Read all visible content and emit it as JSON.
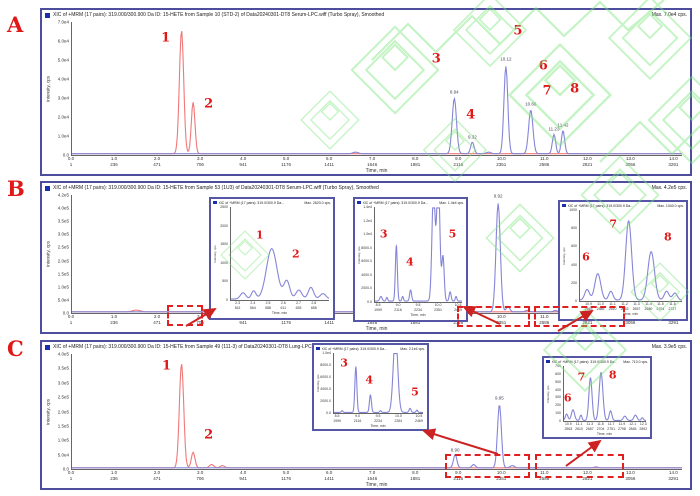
{
  "figure": {
    "panel_labels": [
      "A",
      "B",
      "C"
    ],
    "accent_red": "#e01818",
    "watermark_green": "#7be57b",
    "trace_red": "#f07878",
    "trace_blue": "#8585d8"
  },
  "chart_data": [
    {
      "id": "panel-A-main",
      "type": "line",
      "title": "XIC of +MRM (17 pairs): 319.000/300.900 Da ID: 15-HETE from Sample 10 (STD-2) of Data20240301-DT8 Serum-LPC.wiff (Turbo Spray), Smoothed",
      "max_label": "Max. 7.0e4 cps.",
      "ylabel": "Intensity, cps",
      "xlabel": "Time, min",
      "xmin": 0,
      "xmax": 14.2,
      "yticks": [
        "7.0e4",
        "6.0e4",
        "5.0e4",
        "4.0e4",
        "3.0e4",
        "2.0e4",
        "1.0e4",
        "0.0"
      ],
      "xticks": [
        "0.0",
        "1.0",
        "2.0",
        "3.0",
        "4.0",
        "5.0",
        "6.0",
        "7.0",
        "8.0",
        "9.0",
        "10.0",
        "11.0",
        "12.0",
        "13.0",
        "14.0"
      ],
      "scanticks": [
        "1",
        "236",
        "471",
        "706",
        "941",
        "1176",
        "1411",
        "1646",
        "1881",
        "2116",
        "2351",
        "2586",
        "2821",
        "3056",
        "3291"
      ],
      "traces": [
        {
          "name": "red-trace",
          "color": "#f07878",
          "peaks": [
            {
              "rt": 2.55,
              "h": 0.96,
              "w": 0.05,
              "label": "1",
              "lx": 2.18,
              "ly": 0.12
            },
            {
              "rt": 2.82,
              "h": 0.4,
              "w": 0.042,
              "label": "2",
              "lx": 3.18,
              "ly": 0.62
            }
          ]
        },
        {
          "name": "blue-trace",
          "color": "#8585d8",
          "peaks": [
            {
              "rt": 8.9,
              "h": 0.43,
              "w": 0.05,
              "rt_label": "8.94",
              "label": "3",
              "lx": 8.48,
              "ly": 0.28
            },
            {
              "rt": 9.32,
              "h": 0.09,
              "w": 0.04,
              "rt_label": "9.32",
              "label": "4",
              "lx": 9.28,
              "ly": 0.7
            },
            {
              "rt": 10.1,
              "h": 0.68,
              "w": 0.045,
              "rt_label": "10.12",
              "label": "5",
              "lx": 10.38,
              "ly": 0.07
            },
            {
              "rt": 10.68,
              "h": 0.34,
              "w": 0.05,
              "rt_label": "10.66",
              "label": "6",
              "lx": 10.97,
              "ly": 0.33
            },
            {
              "rt": 11.22,
              "h": 0.15,
              "w": 0.038,
              "rt_label": "11.23",
              "label": "7",
              "lx": 11.06,
              "ly": 0.52
            },
            {
              "rt": 11.43,
              "h": 0.18,
              "w": 0.038,
              "rt_label": "11.42",
              "label": "8",
              "lx": 11.7,
              "ly": 0.5
            },
            {
              "rt": 6.6,
              "h": 0.012,
              "w": 0.06
            },
            {
              "rt": 9.7,
              "h": 0.012,
              "w": 0.05
            }
          ]
        }
      ]
    },
    {
      "id": "panel-B-main",
      "type": "line",
      "title": "XIC of +MRM (17 pairs): 319.000/300.900 Da ID: 15-HETE from Sample 53 (1U3) of Data20240301-DT8 Serum-LPC.wiff (Turbo Spray), Smoothed",
      "max_label": "Max. 4.2e5 cps.",
      "ylabel": "Intensity, cps",
      "xlabel": "Time, min",
      "xmin": 0,
      "xmax": 14.2,
      "yticks": [
        "4.2e5",
        "4.0e5",
        "3.5e5",
        "3.0e5",
        "2.5e5",
        "2.0e5",
        "1.5e5",
        "1.0e5",
        "5.0e4",
        "0.0"
      ],
      "xticks": [
        "0.0",
        "1.0",
        "2.0",
        "3.0",
        "4.0",
        "5.0",
        "6.0",
        "7.0",
        "8.0",
        "9.0",
        "10.0",
        "11.0",
        "12.0",
        "13.0",
        "14.0"
      ],
      "scanticks": [
        "1",
        "236",
        "471",
        "706",
        "941",
        "1176",
        "1411",
        "1646",
        "1881",
        "2116",
        "2351",
        "2586",
        "2821",
        "3056",
        "3291"
      ],
      "traces": [
        {
          "name": "red-trace",
          "color": "#f07878",
          "peaks": [
            {
              "rt": 1.5,
              "h": 0.015,
              "w": 0.09
            }
          ]
        },
        {
          "name": "blue-trace",
          "color": "#8585d8",
          "peaks": [
            {
              "rt": 8.94,
              "h": 0.035,
              "w": 0.04
            },
            {
              "rt": 9.3,
              "h": 0.02,
              "w": 0.04
            },
            {
              "rt": 9.92,
              "h": 0.95,
              "w": 0.05,
              "rt_label": "9.92"
            },
            {
              "rt": 10.15,
              "h": 0.05,
              "w": 0.04
            },
            {
              "rt": 10.6,
              "h": 0.012,
              "w": 0.05
            },
            {
              "rt": 11.25,
              "h": 0.012,
              "w": 0.04
            },
            {
              "rt": 11.45,
              "h": 0.012,
              "w": 0.04
            },
            {
              "rt": 12.1,
              "h": 0.008,
              "w": 0.05
            }
          ]
        }
      ]
    },
    {
      "id": "panel-C-main",
      "type": "line",
      "title": "XIC of +MRM (17 pairs): 319.000/300.900 Da ID: 15-HETE from Sample 49 (111-3) of Data20240301-DT8 Lung-LPC.wiff (Turbo Spray), Smoothed",
      "max_label": "Max. 3.9e5 cps.",
      "ylabel": "Intensity, cps",
      "xlabel": "Time, min",
      "xmin": 0,
      "xmax": 14.2,
      "yticks": [
        "4.0e5",
        "3.5e5",
        "3.0e5",
        "2.5e5",
        "2.0e5",
        "1.5e5",
        "1.0e5",
        "5.0e4",
        "0.0"
      ],
      "xticks": [
        "0.0",
        "1.0",
        "2.0",
        "3.0",
        "4.0",
        "5.0",
        "6.0",
        "7.0",
        "8.0",
        "9.0",
        "10.0",
        "11.0",
        "12.0",
        "13.0",
        "14.0"
      ],
      "scanticks": [
        "1",
        "236",
        "471",
        "706",
        "941",
        "1176",
        "1411",
        "1646",
        "1881",
        "2116",
        "2351",
        "2586",
        "2821",
        "3056",
        "3291"
      ],
      "traces": [
        {
          "name": "red-trace",
          "color": "#f07878",
          "peaks": [
            {
              "rt": 2.55,
              "h": 0.94,
              "w": 0.05,
              "label": "1",
              "lx": 2.2,
              "ly": 0.1
            },
            {
              "rt": 2.82,
              "h": 0.14,
              "w": 0.042,
              "label": "2",
              "lx": 3.18,
              "ly": 0.7
            },
            {
              "rt": 3.25,
              "h": 0.03,
              "w": 0.05
            },
            {
              "rt": 3.5,
              "h": 0.02,
              "w": 0.05
            }
          ]
        },
        {
          "name": "blue-trace",
          "color": "#8585d8",
          "peaks": [
            {
              "rt": 8.92,
              "h": 0.12,
              "w": 0.04,
              "rt_label": "8.90"
            },
            {
              "rt": 9.35,
              "h": 0.03,
              "w": 0.04
            },
            {
              "rt": 9.95,
              "h": 0.57,
              "w": 0.045,
              "rt_label": "9.95"
            },
            {
              "rt": 10.25,
              "h": 0.02,
              "w": 0.05
            },
            {
              "rt": 12.2,
              "h": 0.008,
              "w": 0.05
            }
          ]
        }
      ]
    },
    {
      "id": "inset-B1",
      "type": "line",
      "title": "XIC of +MRM (17 pairs): 319.0/300.9 Da...",
      "max_label": "Max. 2620.0 cps.",
      "ylabel": "Intensity, cps",
      "xlabel": "Time, min",
      "xmin": 2.25,
      "xmax": 2.9,
      "yticks": [
        "2500",
        "2000",
        "1500",
        "1000",
        "500",
        "0"
      ],
      "xticks": [
        "2.3",
        "2.4",
        "2.5",
        "2.6",
        "2.7",
        "2.8"
      ],
      "scanticks": [
        "541",
        "564",
        "588",
        "611",
        "635",
        "658"
      ],
      "traces": [
        {
          "name": "blue-trace",
          "color": "#8585d8",
          "peaks": [
            {
              "rt": 2.33,
              "h": 0.07,
              "w": 0.018
            },
            {
              "rt": 2.4,
              "h": 0.09,
              "w": 0.015
            },
            {
              "rt": 2.52,
              "h": 0.56,
              "w": 0.035,
              "label": "1",
              "lx": 2.44,
              "ly": 0.3
            },
            {
              "rt": 2.62,
              "h": 0.2,
              "w": 0.02,
              "label": "2",
              "lx": 2.68,
              "ly": 0.5
            },
            {
              "rt": 2.7,
              "h": 0.1,
              "w": 0.02
            },
            {
              "rt": 2.78,
              "h": 0.13,
              "w": 0.018
            },
            {
              "rt": 2.86,
              "h": 0.06,
              "w": 0.02
            }
          ]
        }
      ]
    },
    {
      "id": "inset-B2",
      "type": "line",
      "title": "XIC of +MRM (17 pairs): 319.0/300.9 Da...",
      "max_label": "Max. 1.4e4 cps.",
      "ylabel": "Intensity, cps",
      "xlabel": "Time, min",
      "xmin": 8.4,
      "xmax": 10.6,
      "yticks": [
        "1.4e4",
        "1.2e4",
        "1.0e4",
        "8000.0",
        "6000.0",
        "4000.0",
        "2000.0",
        "0.0"
      ],
      "xticks": [
        "8.5",
        "9.0",
        "9.5",
        "10.0",
        "10.5"
      ],
      "scanticks": [
        "1999",
        "2116",
        "2234",
        "2351",
        "2469"
      ],
      "traces": [
        {
          "name": "blue-trace",
          "color": "#8585d8",
          "peaks": [
            {
              "rt": 8.55,
              "h": 0.05,
              "w": 0.03
            },
            {
              "rt": 8.7,
              "h": 0.04,
              "w": 0.02
            },
            {
              "rt": 8.94,
              "h": 0.6,
              "w": 0.025,
              "label": "3",
              "lx": 8.62,
              "ly": 0.28
            },
            {
              "rt": 9.1,
              "h": 0.05,
              "w": 0.02
            },
            {
              "rt": 9.3,
              "h": 0.12,
              "w": 0.025,
              "label": "4",
              "lx": 9.28,
              "ly": 0.58
            },
            {
              "rt": 9.88,
              "h": 1.2,
              "w": 0.04
            },
            {
              "rt": 10.0,
              "h": 1.35,
              "w": 0.04
            },
            {
              "rt": 10.12,
              "h": 0.48,
              "w": 0.03,
              "label": "5",
              "lx": 10.36,
              "ly": 0.28
            },
            {
              "rt": 10.3,
              "h": 0.1,
              "w": 0.025
            },
            {
              "rt": 10.45,
              "h": 0.05,
              "w": 0.02
            }
          ]
        }
      ]
    },
    {
      "id": "inset-B3",
      "type": "line",
      "title": "XIC of +MRM (17 pairs): 319.0/300.9 Da...",
      "max_label": "Max. 1040.0 cps.",
      "ylabel": "Intensity, cps",
      "xlabel": "Time, min",
      "xmin": 10.82,
      "xmax": 11.68,
      "yticks": [
        "1000",
        "800",
        "600",
        "400",
        "200",
        "0"
      ],
      "xticks": [
        "10.9",
        "11.0",
        "11.1",
        "11.2",
        "11.3",
        "11.4",
        "11.5",
        "11.6"
      ],
      "scanticks": [
        "2563",
        "2586",
        "2610",
        "2633",
        "2657",
        "2680",
        "2704",
        "2727"
      ],
      "traces": [
        {
          "name": "blue-trace",
          "color": "#8585d8",
          "peaks": [
            {
              "rt": 10.88,
              "h": 0.12,
              "w": 0.02
            },
            {
              "rt": 10.97,
              "h": 0.3,
              "w": 0.025,
              "label": "6",
              "lx": 10.87,
              "ly": 0.52
            },
            {
              "rt": 11.08,
              "h": 0.1,
              "w": 0.018
            },
            {
              "rt": 11.23,
              "h": 0.9,
              "w": 0.025,
              "label": "7",
              "lx": 11.1,
              "ly": 0.15
            },
            {
              "rt": 11.42,
              "h": 0.55,
              "w": 0.028,
              "label": "8",
              "lx": 11.56,
              "ly": 0.3
            },
            {
              "rt": 11.55,
              "h": 0.1,
              "w": 0.02
            },
            {
              "rt": 11.62,
              "h": 0.08,
              "w": 0.02
            }
          ]
        }
      ]
    },
    {
      "id": "inset-C1",
      "type": "line",
      "title": "XIC of +MRM (17 pairs): 319.0/300.9 Da...",
      "max_label": "Max. 2.1e4 cps.",
      "ylabel": "Intensity, cps",
      "xlabel": "Time, min",
      "xmin": 8.4,
      "xmax": 10.6,
      "yticks": [
        "1.0e4",
        "8000.0",
        "6000.0",
        "4000.0",
        "2000.0",
        "0.0"
      ],
      "xticks": [
        "8.5",
        "9.0",
        "9.5",
        "10.0",
        "10.5"
      ],
      "scanticks": [
        "1999",
        "2116",
        "2234",
        "2351",
        "2469"
      ],
      "traces": [
        {
          "name": "blue-trace",
          "color": "#8585d8",
          "peaks": [
            {
              "rt": 8.6,
              "h": 0.03,
              "w": 0.02
            },
            {
              "rt": 8.94,
              "h": 0.78,
              "w": 0.025,
              "label": "3",
              "lx": 8.65,
              "ly": 0.16
            },
            {
              "rt": 9.3,
              "h": 0.3,
              "w": 0.025,
              "label": "4",
              "lx": 9.27,
              "ly": 0.45
            },
            {
              "rt": 9.55,
              "h": 0.03,
              "w": 0.02
            },
            {
              "rt": 9.92,
              "h": 1.35,
              "w": 0.055
            },
            {
              "rt": 10.28,
              "h": 0.07,
              "w": 0.025,
              "label": "5",
              "lx": 10.4,
              "ly": 0.65
            },
            {
              "rt": 10.45,
              "h": 0.04,
              "w": 0.02
            }
          ]
        }
      ]
    },
    {
      "id": "inset-C2",
      "type": "line",
      "title": "XIC of +MRM (17 pairs): 319.0/300.9 Da...",
      "max_label": "Max. 710.0 cps.",
      "ylabel": "Intensity, cps",
      "xlabel": "Time, min",
      "xmin": 10.8,
      "xmax": 12.35,
      "yticks": [
        "700",
        "600",
        "500",
        "400",
        "300",
        "200",
        "100",
        "0"
      ],
      "xticks": [
        "10.9",
        "11.1",
        "11.3",
        "11.5",
        "11.7",
        "11.9",
        "12.1",
        "12.3"
      ],
      "scanticks": [
        "2563",
        "2610",
        "2657",
        "2704",
        "2751",
        "2798",
        "2845",
        "2892"
      ],
      "traces": [
        {
          "name": "blue-trace",
          "color": "#8585d8",
          "peaks": [
            {
              "rt": 10.85,
              "h": 0.12,
              "w": 0.025
            },
            {
              "rt": 10.97,
              "h": 0.2,
              "w": 0.03,
              "label": "6",
              "lx": 10.87,
              "ly": 0.58
            },
            {
              "rt": 11.12,
              "h": 0.1,
              "w": 0.02
            },
            {
              "rt": 11.3,
              "h": 0.8,
              "w": 0.03,
              "label": "7",
              "lx": 11.13,
              "ly": 0.2
            },
            {
              "rt": 11.5,
              "h": 0.9,
              "w": 0.035,
              "label": "8",
              "lx": 11.72,
              "ly": 0.16
            },
            {
              "rt": 11.68,
              "h": 0.18,
              "w": 0.025
            },
            {
              "rt": 11.95,
              "h": 0.08,
              "w": 0.03
            },
            {
              "rt": 12.15,
              "h": 0.1,
              "w": 0.03
            },
            {
              "rt": 12.28,
              "h": 0.05,
              "w": 0.02
            }
          ]
        }
      ]
    }
  ]
}
